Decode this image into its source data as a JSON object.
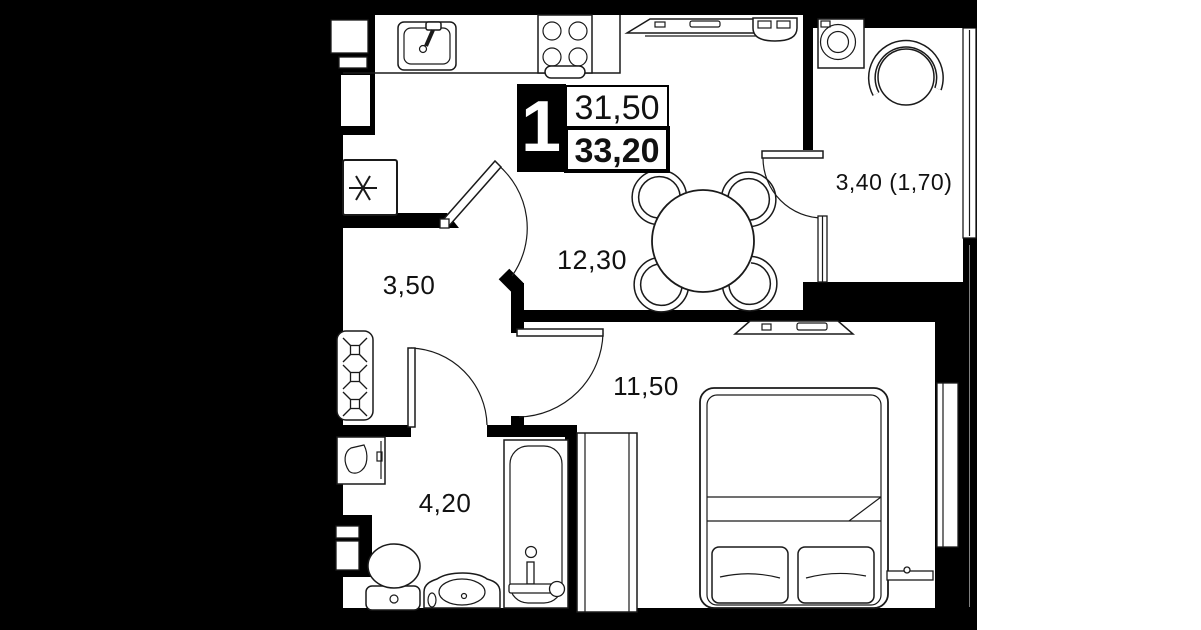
{
  "plan": {
    "title": "one-room apartment floor plan",
    "unit_badge": {
      "number": "1",
      "area_upper": "31,50",
      "area_lower": "33,20"
    },
    "rooms": {
      "kitchen_living": {
        "label": "12,30"
      },
      "hallway": {
        "label": "3,50"
      },
      "bedroom": {
        "label": "11,50"
      },
      "bathroom": {
        "label": "4,20"
      },
      "balcony": {
        "label": "3,40 (1,70)"
      }
    },
    "furniture": {
      "kitchen": [
        "sink",
        "cooktop",
        "fridge",
        "counter"
      ],
      "living": [
        "tv-console",
        "ac-unit",
        "round-dining-table",
        "four-chairs"
      ],
      "hallway": [
        "open-wardrobe-with-hangers"
      ],
      "bathroom": [
        "toilet",
        "washbasin",
        "bathtub",
        "water-heater-cabinet"
      ],
      "bedroom": [
        "double-bed",
        "two-pillows",
        "wardrobe",
        "tv-console",
        "radiator",
        "window"
      ],
      "balcony": [
        "washing-machine",
        "round-chair",
        "glazing",
        "balcony-door"
      ]
    },
    "colors": {
      "wall": "#000000",
      "floor": "#ffffff",
      "line": "#1a1a1a",
      "badge_bg": "#000000",
      "badge_text": "#ffffff",
      "label_text": "#111111"
    }
  }
}
